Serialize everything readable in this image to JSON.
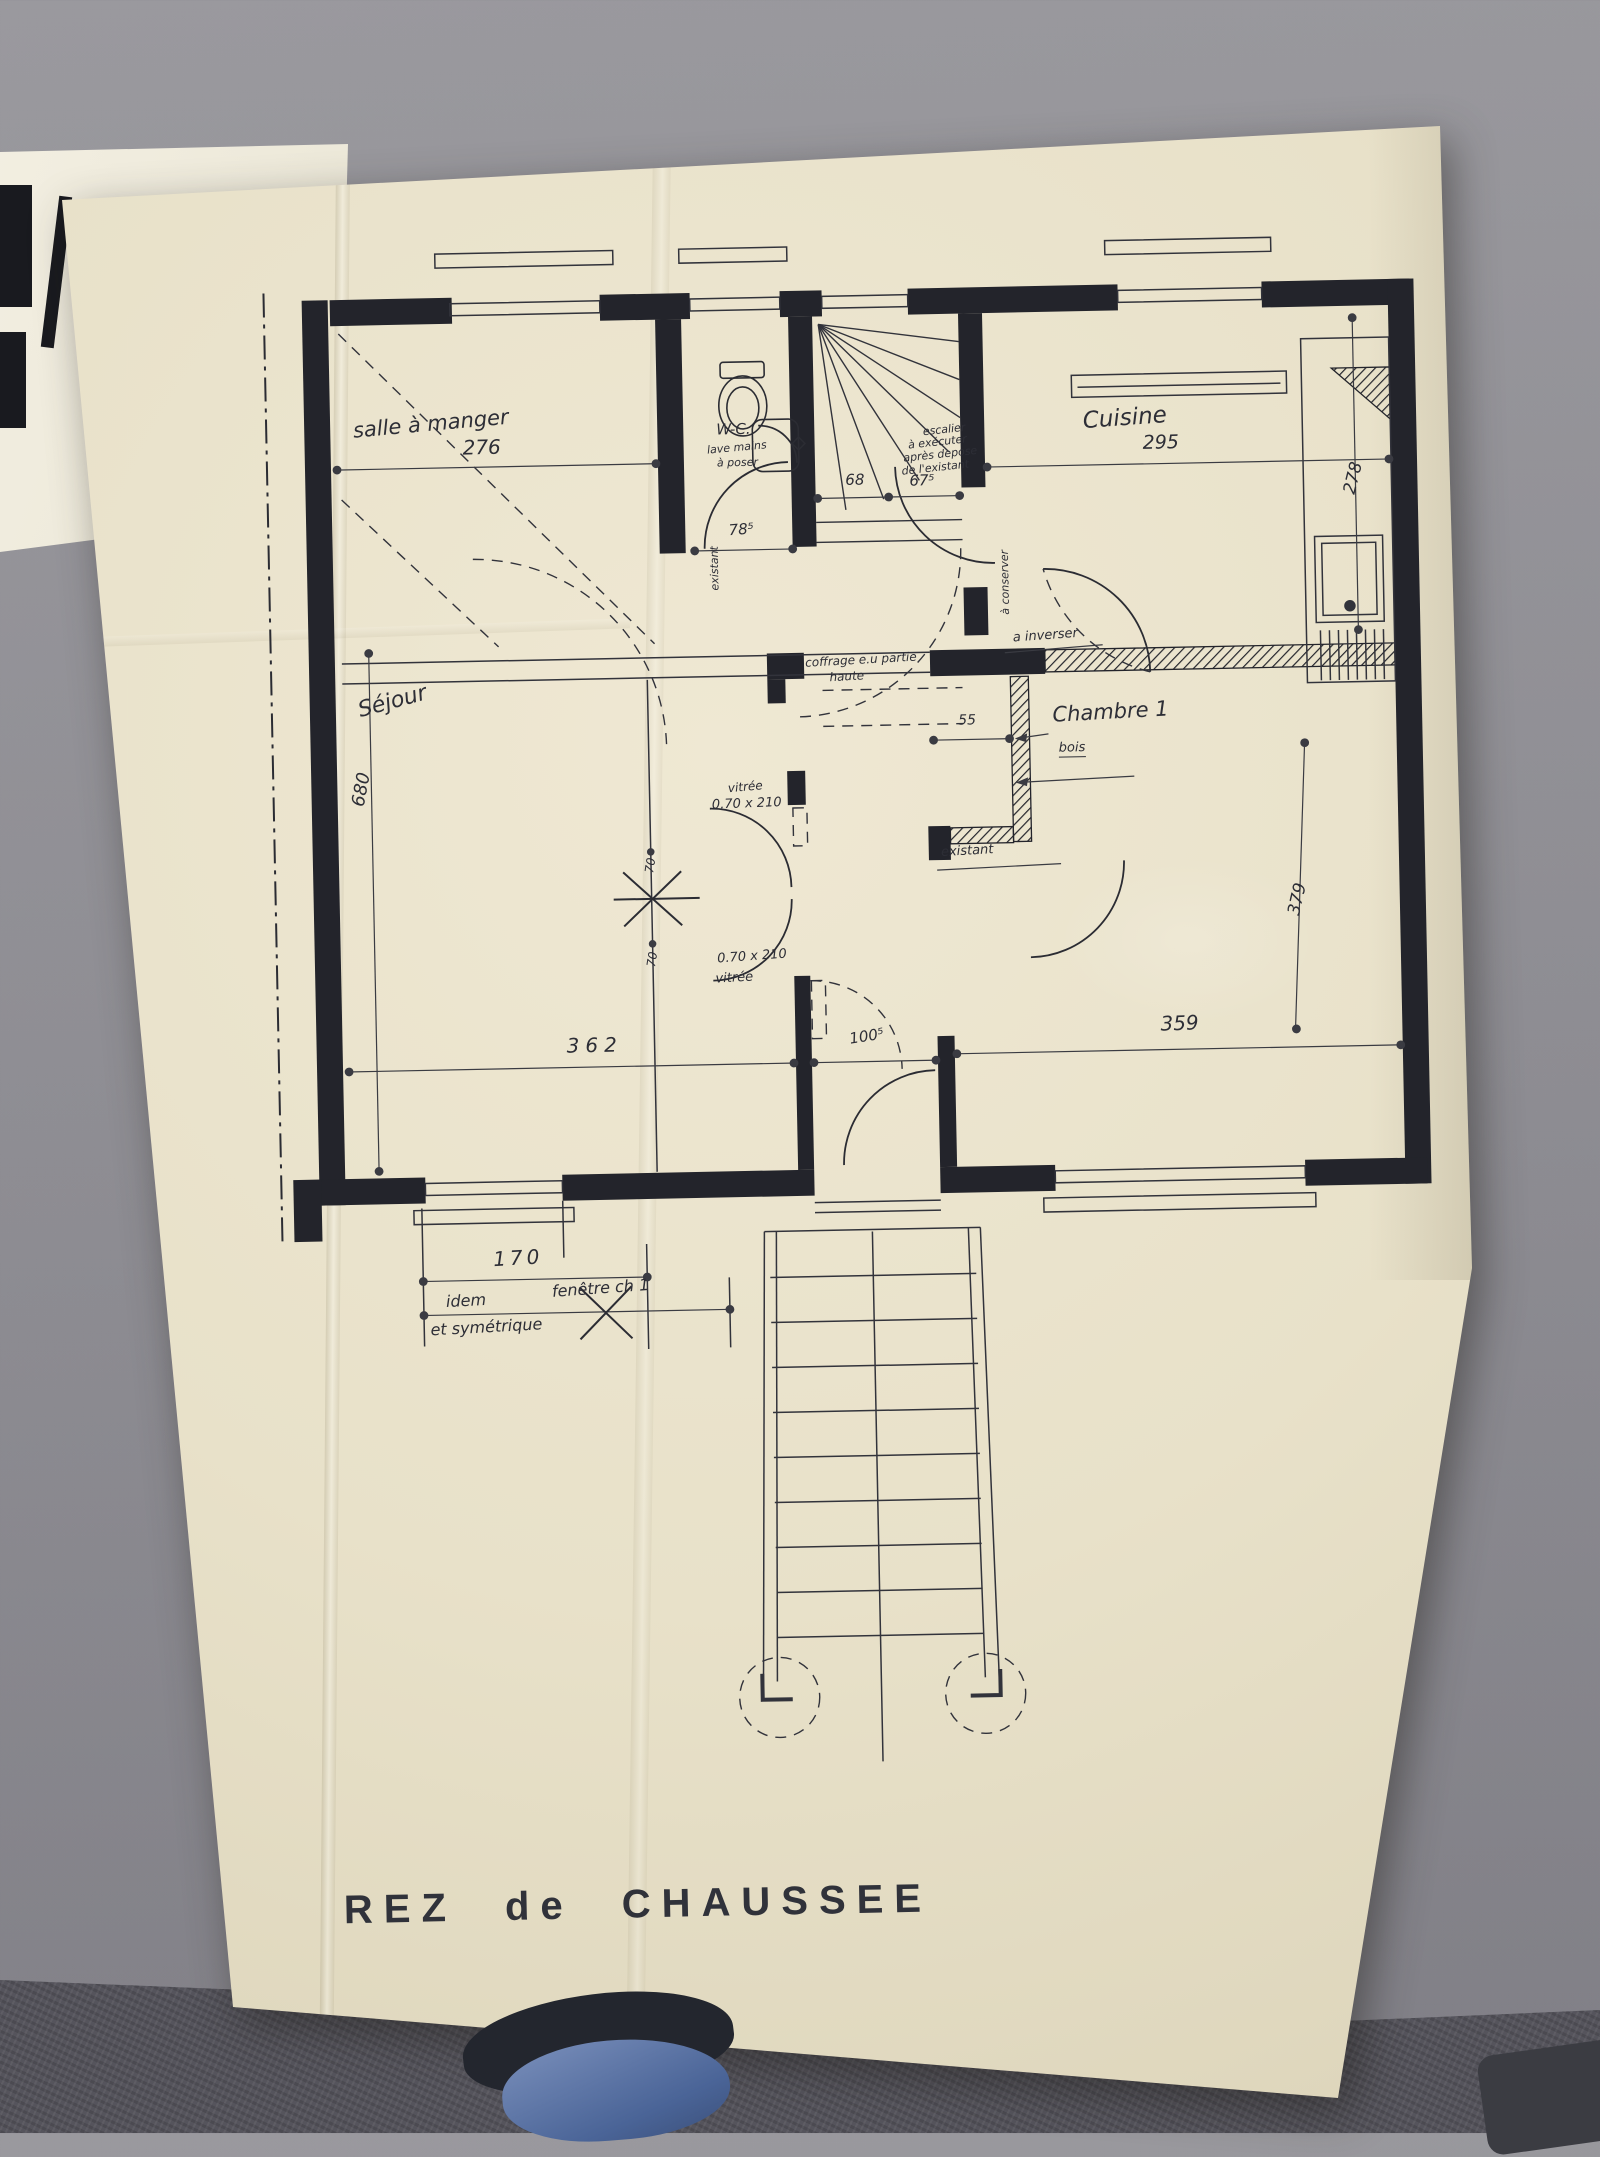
{
  "meta": {
    "document_type": "hand-drawn architectural floor plan (photograph)",
    "drawing_title": "REZ de CHAUSSEE"
  },
  "colors": {
    "paper": "#e8e1c9",
    "ink": "#23242b",
    "background_floor": "#8d8c92",
    "carpet": "#55545c",
    "shoe": "#4a6497"
  },
  "labels": {
    "title": "REZ de CHAUSSEE",
    "salle_a_manger": "salle à manger",
    "wc": "W-C.",
    "wc_note1": "lave mains",
    "wc_note2": "à poser",
    "cuisine": "Cuisine",
    "sejour": "Séjour",
    "chambre1": "Chambre 1",
    "bois": "bois",
    "escalier1": "escalier",
    "escalier2": "à exécuter",
    "escalier3": "après depose",
    "escalier4": "de l'existant",
    "coffrage1": "coffrage e.u partie",
    "coffrage2": "haute",
    "a_inverser": "a inverser",
    "a_conserver": "à conserver",
    "existant_wc": "existant",
    "existant_chambre": "existant",
    "vitree": "vitrée",
    "porte_vitree": "0.70 x 210",
    "fenetre_idem": "idem",
    "fenetre_ch1": "fenêtre ch 1",
    "fenetre_sym": "et symétrique"
  },
  "dims": {
    "salle_largeur": "276",
    "wc_largeur": "78⁵",
    "escalier_a": "68",
    "escalier_b": "67⁵",
    "cuisine_largeur": "295",
    "cuisine_profondeur": "278",
    "sejour_hauteur": "680",
    "cloison_bois": "55",
    "porte_haut": "70",
    "porte_bas": "70",
    "chambre_profondeur": "379",
    "sejour_largeur": "362",
    "entree_largeur": "100⁵",
    "chambre_largeur": "359",
    "fenetre_largeur": "170"
  }
}
